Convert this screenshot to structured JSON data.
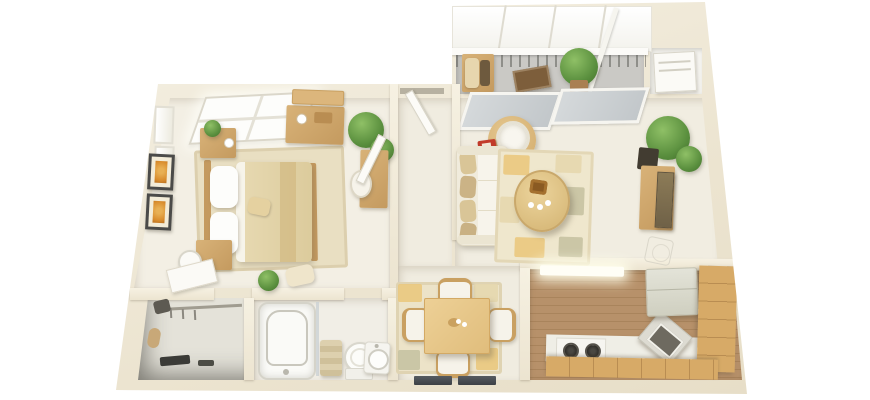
{
  "scene": {
    "type": "3d-floor-plan-render",
    "subject": "Top-down 3D floor plan of a one-bedroom apartment with balcony",
    "view": "isometric top-down",
    "background_color": "#ffffff",
    "wall_color": "#efe8d7",
    "floor_color": "#f1ede1"
  },
  "palette": {
    "wall": "#efe8d7",
    "wall_shadow": "#ddd5c0",
    "floor_light": "#f1ede1",
    "balcony_floor": "#cac9c5",
    "closet_floor": "#e4e2d9",
    "kitchen_wood": "#b5906a",
    "kitchen_wood_dark": "#a9845c",
    "wood_furniture": "#cfa667",
    "wood_table": "#e9ca8d",
    "rug_bedroom": "#e9dfc2",
    "rug_living": "#efe7cd",
    "rug_dining": "#ece3c8",
    "patch_mustard": "#eac87e",
    "patch_sage": "#c7c2a2",
    "duvet_tan": "#e2d3aa",
    "linen_white": "#fbfbf8",
    "sofa_cream": "#f0ebdc",
    "cushion_tan": "#d9c597",
    "plant_green": "#69a04c",
    "pot_terracotta": "#a97f52",
    "pot_dark": "#423c31",
    "tv_panel": "#857352",
    "appliance_white": "#f6f5f0",
    "fridge_gray": "#d9d9cc",
    "burner_black": "#35332f",
    "art_frame_dark": "#4b4b49",
    "art_orange": "#d98d2e",
    "balcony_mat_brown": "#7d5e3b",
    "window_glass_gray": "#ccd1d3",
    "accent_red": "#c23b2a",
    "dark_floor_slot": "#4a4e52"
  },
  "rooms": [
    {
      "id": "balcony",
      "label": "Balcony",
      "items": [
        "glass-canopy",
        "white-railing",
        "outdoor-chair",
        "brown-mat",
        "potted-plant"
      ]
    },
    {
      "id": "utility-niche",
      "label": "Utility niche",
      "items": [
        "white-appliance"
      ]
    },
    {
      "id": "bedroom",
      "label": "Bedroom",
      "items": [
        "double-bed",
        "white-pillows",
        "tan-duvet",
        "nightstand-with-plant",
        "nightstand",
        "laundry-basket",
        "dresser",
        "wall-shelf",
        "corner-plant",
        "desk",
        "desk-chair",
        "area-rug",
        "framed-art-x2",
        "skylight-window",
        "side-windows-x2",
        "door"
      ]
    },
    {
      "id": "hallway",
      "label": "Entry hall",
      "items": [
        "entry-door",
        "threshold"
      ]
    },
    {
      "id": "living-room",
      "label": "Living room",
      "items": [
        "cream-sofa",
        "patterned-rug",
        "oval-coffee-table",
        "decor-bowl",
        "cups-x3",
        "round-side-table",
        "lamp",
        "red-box",
        "tv-console",
        "tv-panel",
        "corner-plant",
        "top-wall-windows-x2",
        "sketch-stool"
      ]
    },
    {
      "id": "dining-area",
      "label": "Dining area",
      "items": [
        "square-wood-table",
        "dining-chairs-x4",
        "area-rug",
        "centerpiece",
        "dark-floor-vents-x2"
      ]
    },
    {
      "id": "kitchen",
      "label": "Kitchen",
      "items": [
        "plank-wood-floor",
        "ceiling-light-bar",
        "white-counter",
        "cooktop-2-burners",
        "angled-oven",
        "refrigerator",
        "wood-cabinets-right",
        "wood-cabinets-bottom"
      ]
    },
    {
      "id": "bathroom",
      "label": "Bathroom",
      "items": [
        "bathtub",
        "glass-divider",
        "towel-stack",
        "toilet",
        "pedestal-sink"
      ]
    },
    {
      "id": "walk-in-closet",
      "label": "Walk-in closet",
      "items": [
        "clothes-rail",
        "hangers",
        "dark-box",
        "tan-roll",
        "shoes"
      ]
    }
  ],
  "counts": {
    "bedrooms": 1,
    "bathrooms": 1,
    "balconies": 1,
    "dining_chairs": 4,
    "cooktop_burners": 2,
    "framed_pictures": 2,
    "indoor_plants": 4
  }
}
